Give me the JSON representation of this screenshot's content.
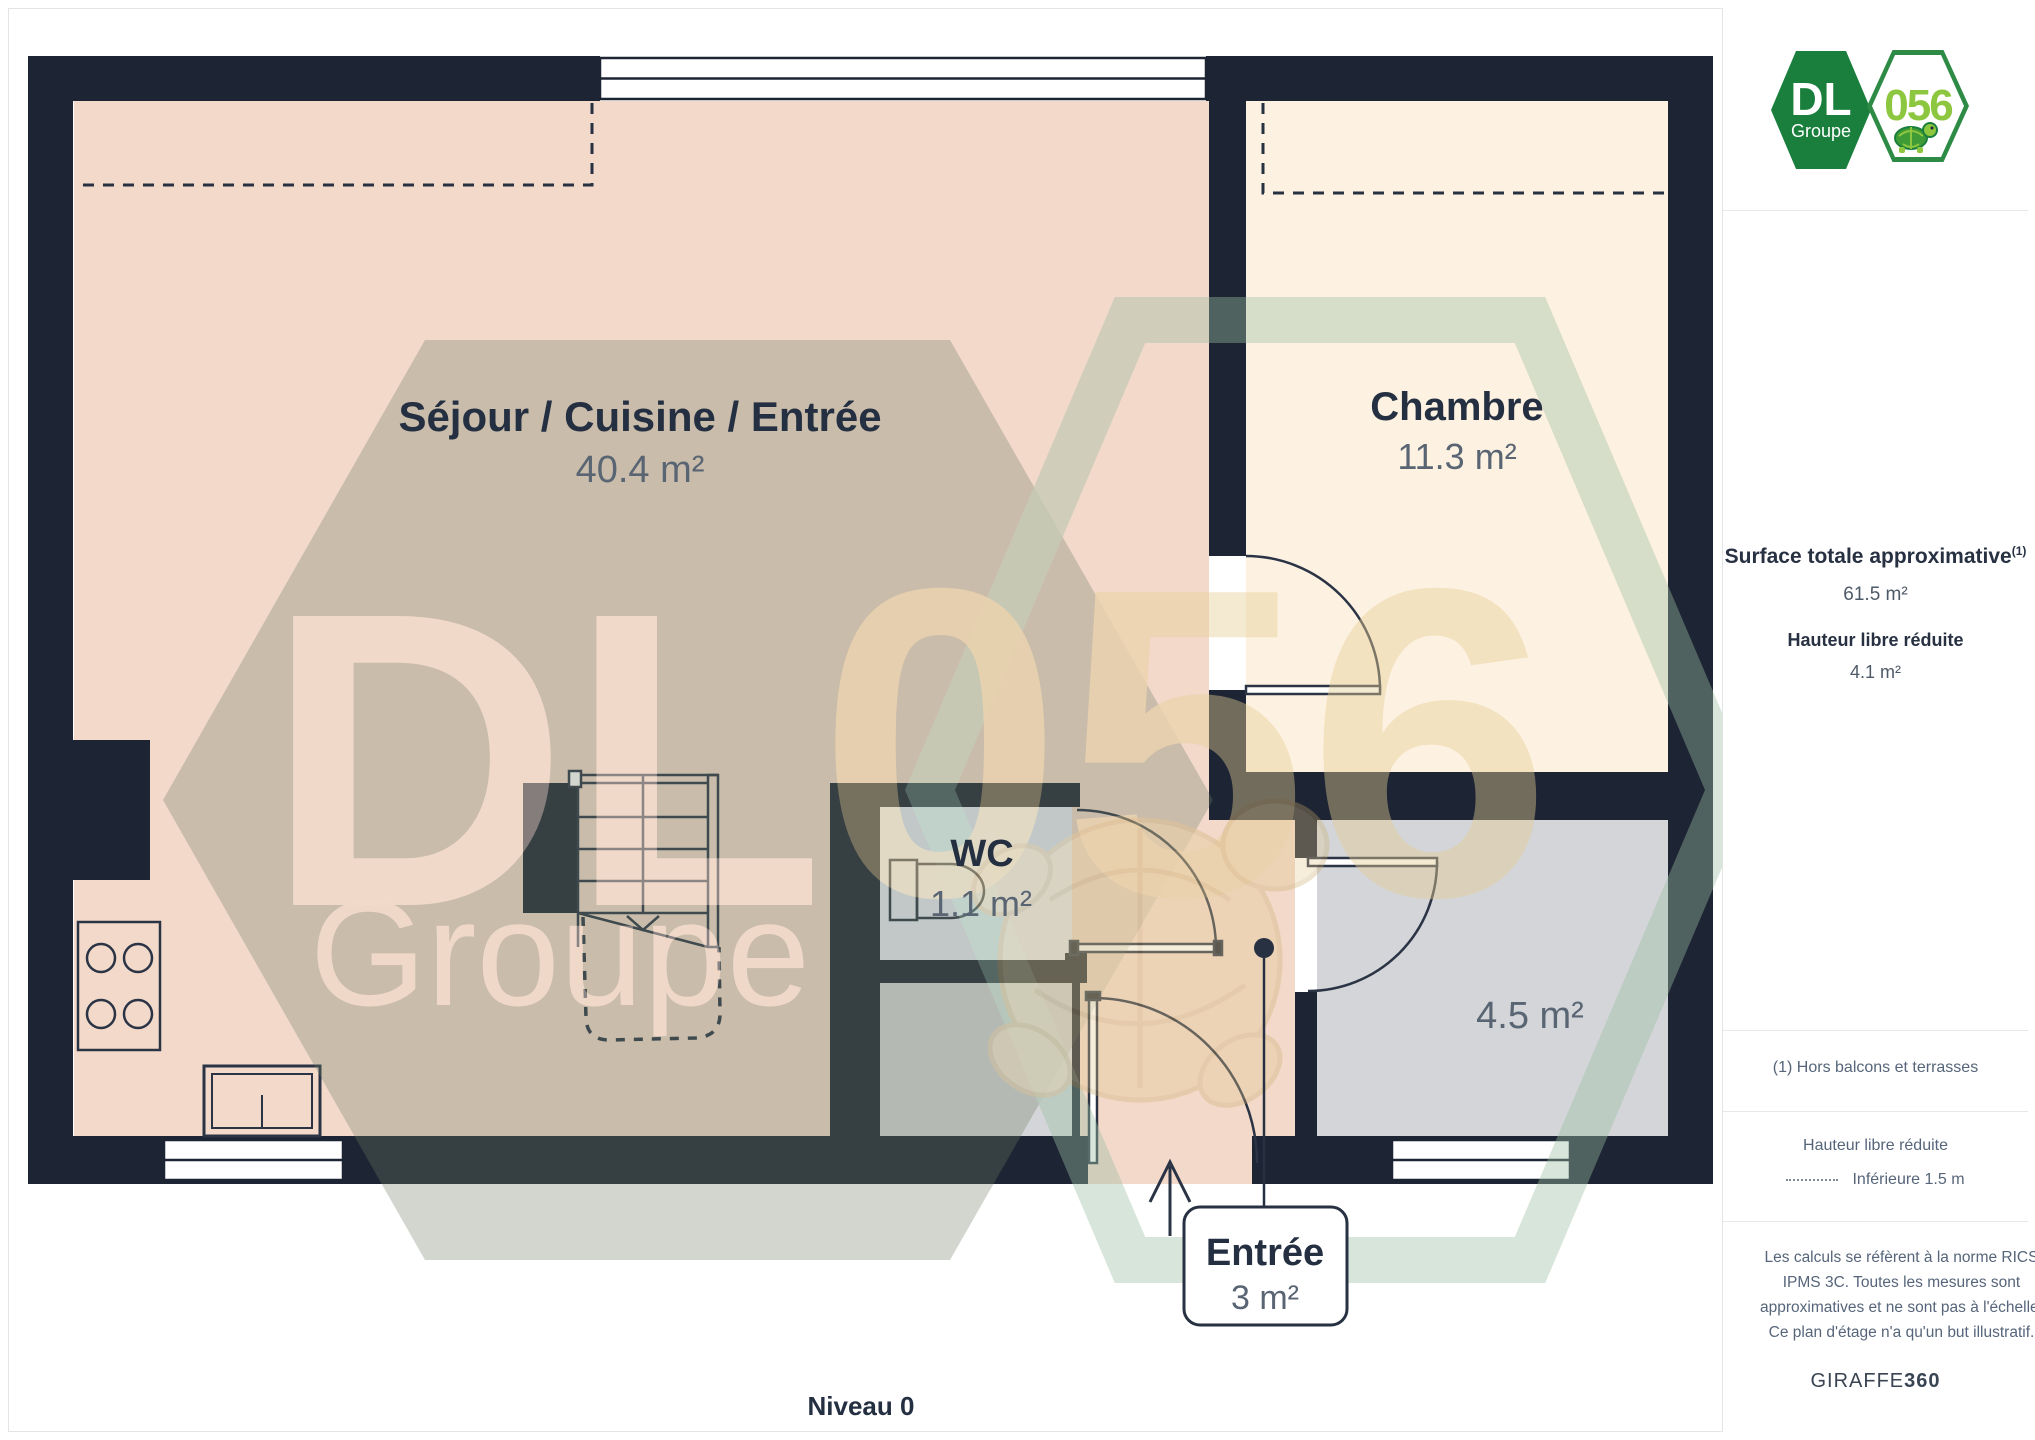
{
  "page": {
    "level_label": "Niveau 0"
  },
  "logo": {
    "dl": "DL",
    "groupe": "Groupe",
    "badge": "056"
  },
  "sidebar": {
    "surface_title": "Surface totale approximative",
    "surface_footnote": "(1)",
    "surface_value": "61.5 m²",
    "height_title": "Hauteur libre réduite",
    "height_value": "4.1 m²",
    "footnote": "(1) Hors balcons et terrasses",
    "legend_title": "Hauteur libre réduite",
    "legend_value": "Inférieure 1.5 m",
    "disclaimer": "Les calculs se réfèrent à la norme RICS IPMS 3C. Toutes les mesures sont approximatives et ne sont pas à l'échelle. Ce plan d'étage n'a qu'un but illustratif.",
    "brand": "GIRAFFE",
    "brand_suffix": "360"
  },
  "rooms": {
    "sejour": {
      "name": "Séjour / Cuisine / Entrée",
      "area": "40.4 m²"
    },
    "chambre": {
      "name": "Chambre",
      "area": "11.3 m²"
    },
    "wc": {
      "name": "WC",
      "area": "1.1 m²"
    },
    "storage": {
      "area": "4.5 m²"
    },
    "entree": {
      "name": "Entrée",
      "area": "3 m²"
    }
  },
  "watermark": {
    "dl": "DL",
    "groupe": "Groupe",
    "badge": "056"
  },
  "colors": {
    "wall": "#1d2433",
    "floor_main": "#f2d9ca",
    "floor_bedroom": "#fdf1e1",
    "floor_wc": "#e7ebf4",
    "floor_gray": "#d3d5d8",
    "label_dark": "#243041",
    "label_gray": "#5a6574",
    "logo_green_dark": "#1a7f3c",
    "logo_green_lime": "#8dc63f"
  }
}
